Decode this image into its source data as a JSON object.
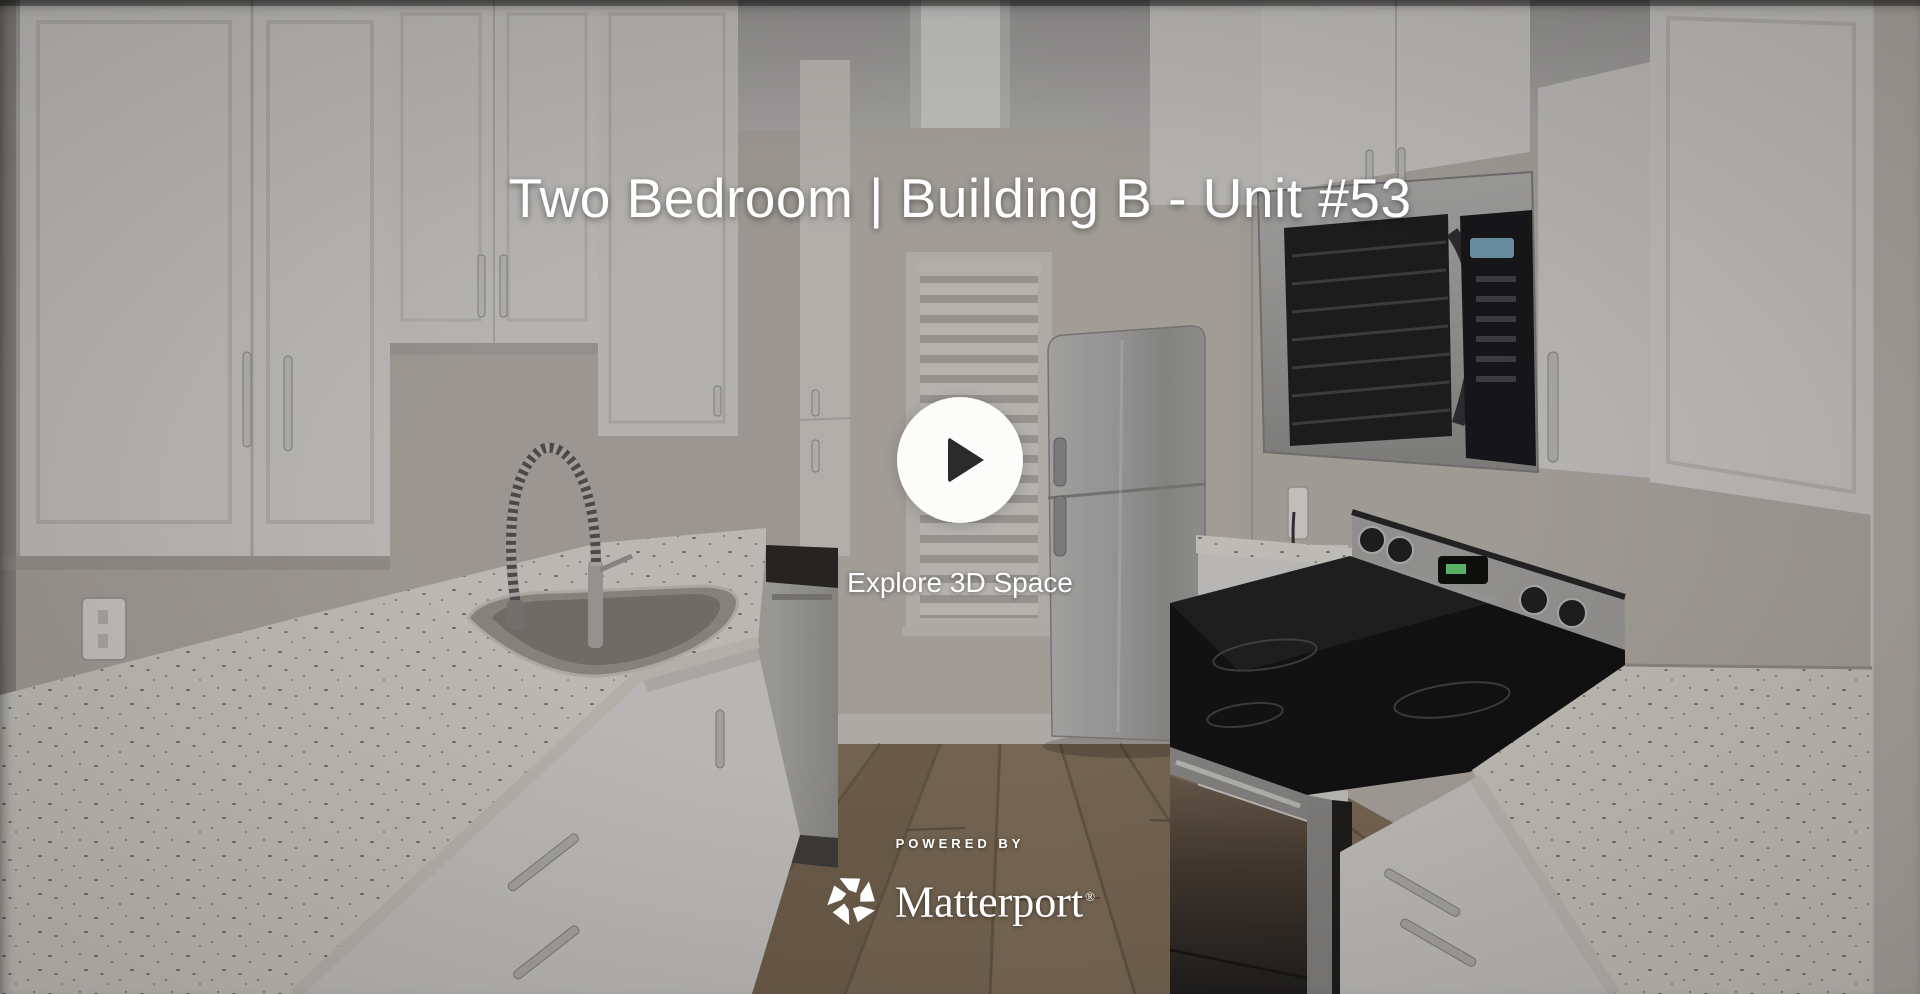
{
  "overlay": {
    "title": "Two Bedroom | Building B - Unit #53",
    "play_label": "Explore 3D Space",
    "powered_by": "POWERED BY",
    "brand": {
      "name": "Matterport",
      "registered_mark": "®"
    }
  },
  "icons": {
    "play": "play-icon",
    "logo": "matterport-logo-icon"
  },
  "colors": {
    "title_text": "#ffffff",
    "play_button_bg": "#fcfcfb",
    "play_icon": "#2b2b2b",
    "brand_text": "#ffffff",
    "scrim": "#000000",
    "scrim_opacity": 0.22,
    "floor_wood": "#8e7a64",
    "cabinet_white": "#e6e4e1",
    "counter_speckled": "#e9e6de",
    "appliance_steel": "#b0afad",
    "cooktop_black": "#161617"
  }
}
